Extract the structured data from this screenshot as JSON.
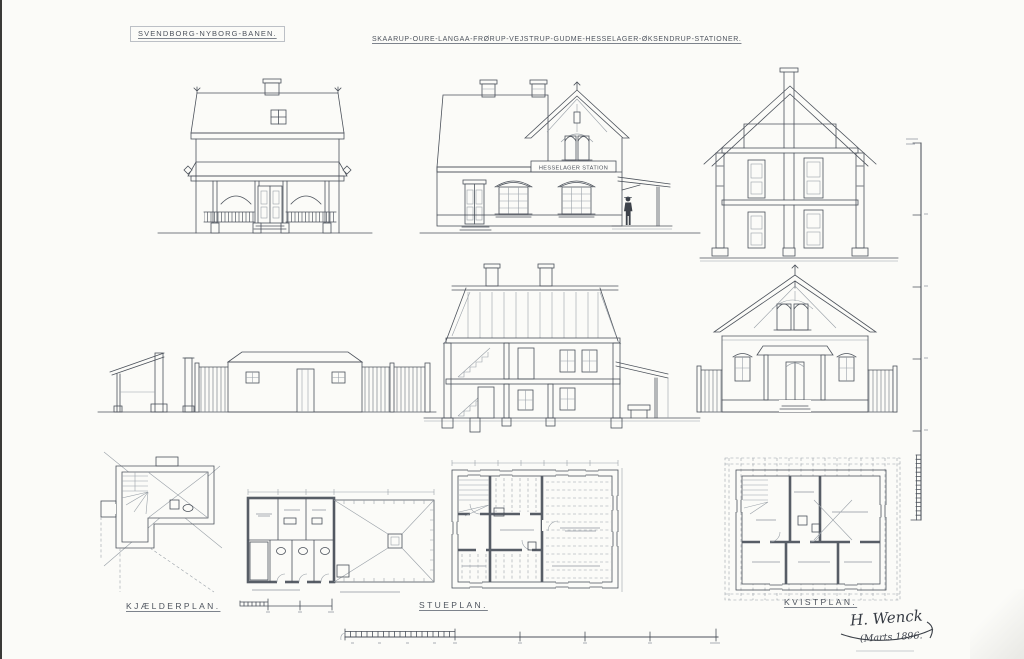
{
  "colors": {
    "paper": "#fbfbf8",
    "ink": "#4c525b"
  },
  "header": {
    "railway_title": "SVENDBORG-NYBORG-BANEN.",
    "stations_title": "SKAARUP-OURE-LANGAA-FRØRUP-VEJSTRUP-GUDME-HESSELAGER-ØKSENDRUP-STATIONER."
  },
  "station_building": {
    "sign": "HESSELAGER STATION"
  },
  "plan_labels": {
    "basement": "KJÆLDERPLAN.",
    "ground_floor": "STUEPLAN.",
    "attic": "KVISTPLAN."
  },
  "signature": {
    "architect": "H. Wenck",
    "date": "(Marts 1896."
  }
}
